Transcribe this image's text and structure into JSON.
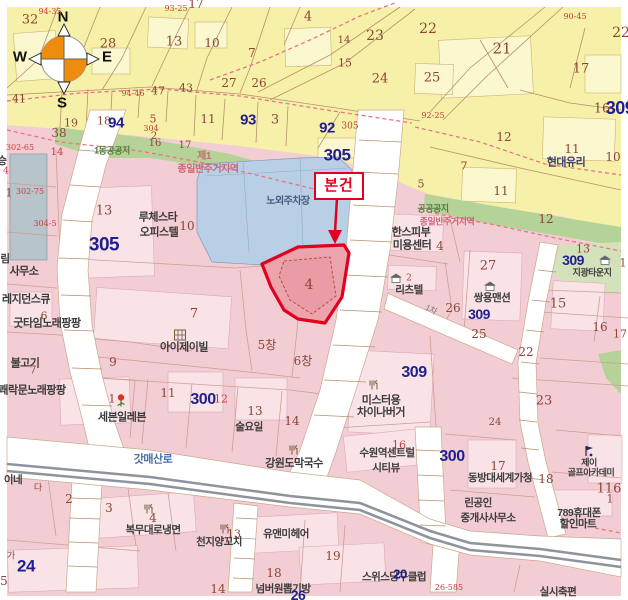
{
  "subject": {
    "label": "본건"
  },
  "compass": {
    "n": "N",
    "w": "W",
    "e": "E",
    "s": "S"
  },
  "colors": {
    "accent_red": "#e3001e",
    "zone_yellow": "#f7f0a8",
    "zone_pink": "#f3cdd4",
    "zone_green": "#b5d398",
    "parking_blue": "#b9cfe6",
    "block_number_blue": "#1f1f8f"
  },
  "labels": [
    {
      "t": "32"
    },
    {
      "t": "94-35"
    },
    {
      "t": "17"
    },
    {
      "t": "93-25"
    },
    {
      "t": "4"
    },
    {
      "t": "23"
    },
    {
      "t": "22"
    },
    {
      "t": "14"
    },
    {
      "t": "28"
    },
    {
      "t": "13"
    },
    {
      "t": "10"
    },
    {
      "t": "7"
    },
    {
      "t": "15"
    },
    {
      "t": "21"
    },
    {
      "t": "90-45"
    },
    {
      "t": "22"
    },
    {
      "t": "25"
    },
    {
      "t": "24"
    },
    {
      "t": "17"
    },
    {
      "t": "27"
    },
    {
      "t": "26"
    },
    {
      "t": "47"
    },
    {
      "t": "43"
    },
    {
      "t": "41"
    },
    {
      "t": "92-25"
    },
    {
      "t": "94-46"
    },
    {
      "t": "16"
    },
    {
      "t": "309"
    },
    {
      "t": "12"
    },
    {
      "t": "11"
    },
    {
      "t": "10"
    },
    {
      "t": "현대유리"
    },
    {
      "t": "7"
    },
    {
      "t": "11"
    },
    {
      "t": "93"
    },
    {
      "t": "3"
    },
    {
      "t": "92"
    },
    {
      "t": "305"
    },
    {
      "t": "19"
    },
    {
      "t": "18"
    },
    {
      "t": "94"
    },
    {
      "t": "5"
    },
    {
      "t": "304"
    },
    {
      "t": "2"
    },
    {
      "t": "16"
    },
    {
      "t": "17"
    },
    {
      "t": "38"
    },
    {
      "t": "302-65"
    },
    {
      "t": "14"
    },
    {
      "t": "305"
    },
    {
      "t": "11"
    },
    {
      "t": "5"
    },
    {
      "t": "12"
    },
    {
      "t": "13"
    },
    {
      "t": "309"
    },
    {
      "t": "지광타운지"
    },
    {
      "t": "1"
    },
    {
      "t": "1동공공지"
    },
    {
      "t": "공공공지"
    },
    {
      "t": "종일반주거지역"
    },
    {
      "t": "제1"
    },
    {
      "t": "종일반주거지역"
    },
    {
      "t": "노외주차장"
    },
    {
      "t": "13"
    },
    {
      "t": "루체스타"
    },
    {
      "t": "오피스텔"
    },
    {
      "t": "10"
    },
    {
      "t": "305"
    },
    {
      "t": "4"
    },
    {
      "t": "한스피부"
    },
    {
      "t": "미용센터"
    },
    {
      "t": "4"
    },
    {
      "t": "27"
    },
    {
      "t": "쌍용맨션"
    },
    {
      "t": "26"
    },
    {
      "t": "309"
    },
    {
      "t": "25"
    },
    {
      "t": "15"
    },
    {
      "t": "16"
    },
    {
      "t": "17"
    },
    {
      "t": "22"
    },
    {
      "t": "리츠텔"
    },
    {
      "t": "2"
    },
    {
      "t": "7"
    },
    {
      "t": "아이제이빌"
    },
    {
      "t": "5창"
    },
    {
      "t": "6창"
    },
    {
      "t": "6"
    },
    {
      "t": "굿타임노래팡팡"
    },
    {
      "t": "레지던스큐"
    },
    {
      "t": "사무소"
    },
    {
      "t": "림"
    },
    {
      "t": "승"
    },
    {
      "t": "4"
    },
    {
      "t": "302-75"
    },
    {
      "t": "1"
    },
    {
      "t": "304-5"
    },
    {
      "t": "불고기"
    },
    {
      "t": "7"
    },
    {
      "t": "쾌락문노래팡팡"
    },
    {
      "t": "9"
    },
    {
      "t": "1"
    },
    {
      "t": "세븐일레븐"
    },
    {
      "t": "11"
    },
    {
      "t": "12"
    },
    {
      "t": "300"
    },
    {
      "t": "13"
    },
    {
      "t": "술요일"
    },
    {
      "t": "14"
    },
    {
      "t": "309"
    },
    {
      "t": "미스터용"
    },
    {
      "t": "차이나버거"
    },
    {
      "t": "16"
    },
    {
      "t": "수원역센트럴"
    },
    {
      "t": "시티뷰"
    },
    {
      "t": "300"
    },
    {
      "t": "23"
    },
    {
      "t": "24"
    },
    {
      "t": "17"
    },
    {
      "t": "동방대세계가청"
    },
    {
      "t": "18"
    },
    {
      "t": "제이"
    },
    {
      "t": "골프아카데미"
    },
    {
      "t": "116"
    },
    {
      "t": "1"
    },
    {
      "t": "린공인"
    },
    {
      "t": "중개사사무소"
    },
    {
      "t": "789휴대폰"
    },
    {
      "t": "할인마트"
    },
    {
      "t": "갓매산로"
    },
    {
      "t": "이네"
    },
    {
      "t": "다"
    },
    {
      "t": "2"
    },
    {
      "t": "3"
    },
    {
      "t": "4"
    },
    {
      "t": "복무대로냉면"
    },
    {
      "t": "천지양꼬치"
    },
    {
      "t": "13"
    },
    {
      "t": "가"
    },
    {
      "t": "24"
    },
    {
      "t": "5"
    },
    {
      "t": "14"
    },
    {
      "t": "유앤미헤어"
    },
    {
      "t": "19"
    },
    {
      "t": "18"
    },
    {
      "t": "넘버원뽑기방"
    },
    {
      "t": "26"
    },
    {
      "t": "스위스당구클럽"
    },
    {
      "t": "20"
    },
    {
      "t": "26-585"
    },
    {
      "t": "실시축편"
    },
    {
      "t": "1차"
    },
    {
      "t": "강원도막국수"
    }
  ]
}
